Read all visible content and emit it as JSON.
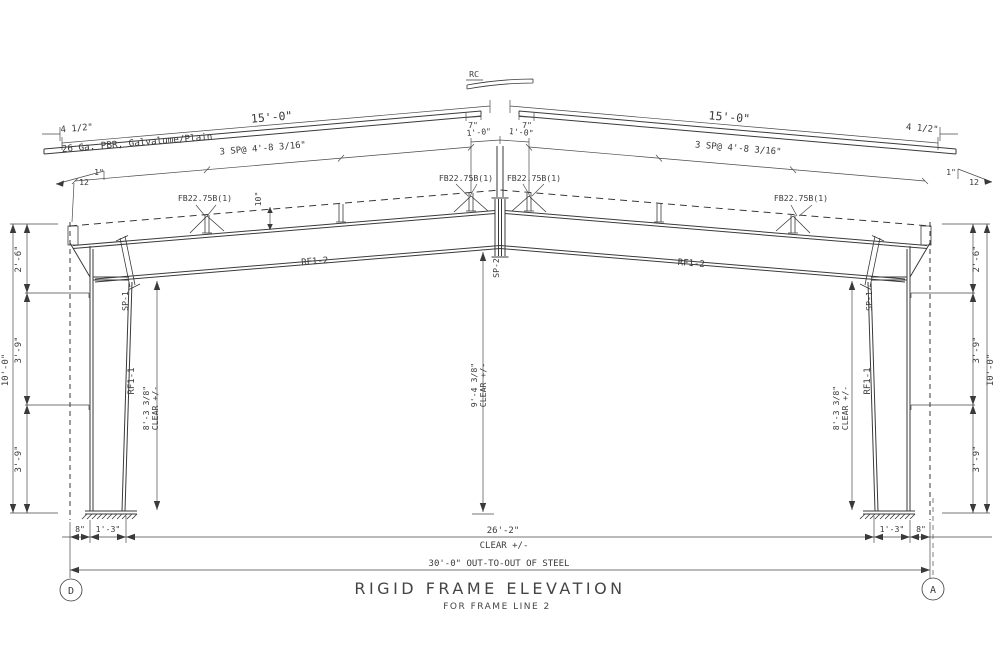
{
  "drawing": {
    "title": "RIGID FRAME ELEVATION",
    "subtitle": "FOR FRAME LINE 2",
    "grid": {
      "left_bubble": "D",
      "right_bubble": "A"
    },
    "roof": {
      "ridge_cap": "RC",
      "panel_note": "26 Ga. PBR, Galvalume/Plain",
      "slope_rise": "1\"",
      "slope_run": "12",
      "purlin_depth": "10\""
    },
    "members": {
      "flange_brace": "FB22.75B(1)",
      "rafter_mark": "RF1-2",
      "column_mark": "RF1-1",
      "eave_strut_mark": "SP-1",
      "ridge_strut_mark": "SP-2"
    },
    "dims": {
      "half_span": "15'-0\"",
      "panel_edge": "4 1/2\"",
      "ridge_offset": "7\"",
      "ridge_purlin": "1'-0\"",
      "purlin_spacing": "3 SP@ 4'-8 3/16\"",
      "eave_upper": "2'-6\"",
      "eave_mid": "3'-9\"",
      "eave_lower": "3'-9\"",
      "eave_height": "10'-0\"",
      "eave_clear": "8'-3 3/8\"",
      "center_clear": "9'-4 3/8\"",
      "clear_suffix": "CLEAR +/-",
      "base_outer": "8\"",
      "base_inner": "1'-3\"",
      "width_clear": "26'-2\"",
      "width_overall": "30'-0\" OUT-TO-OUT OF STEEL"
    }
  }
}
